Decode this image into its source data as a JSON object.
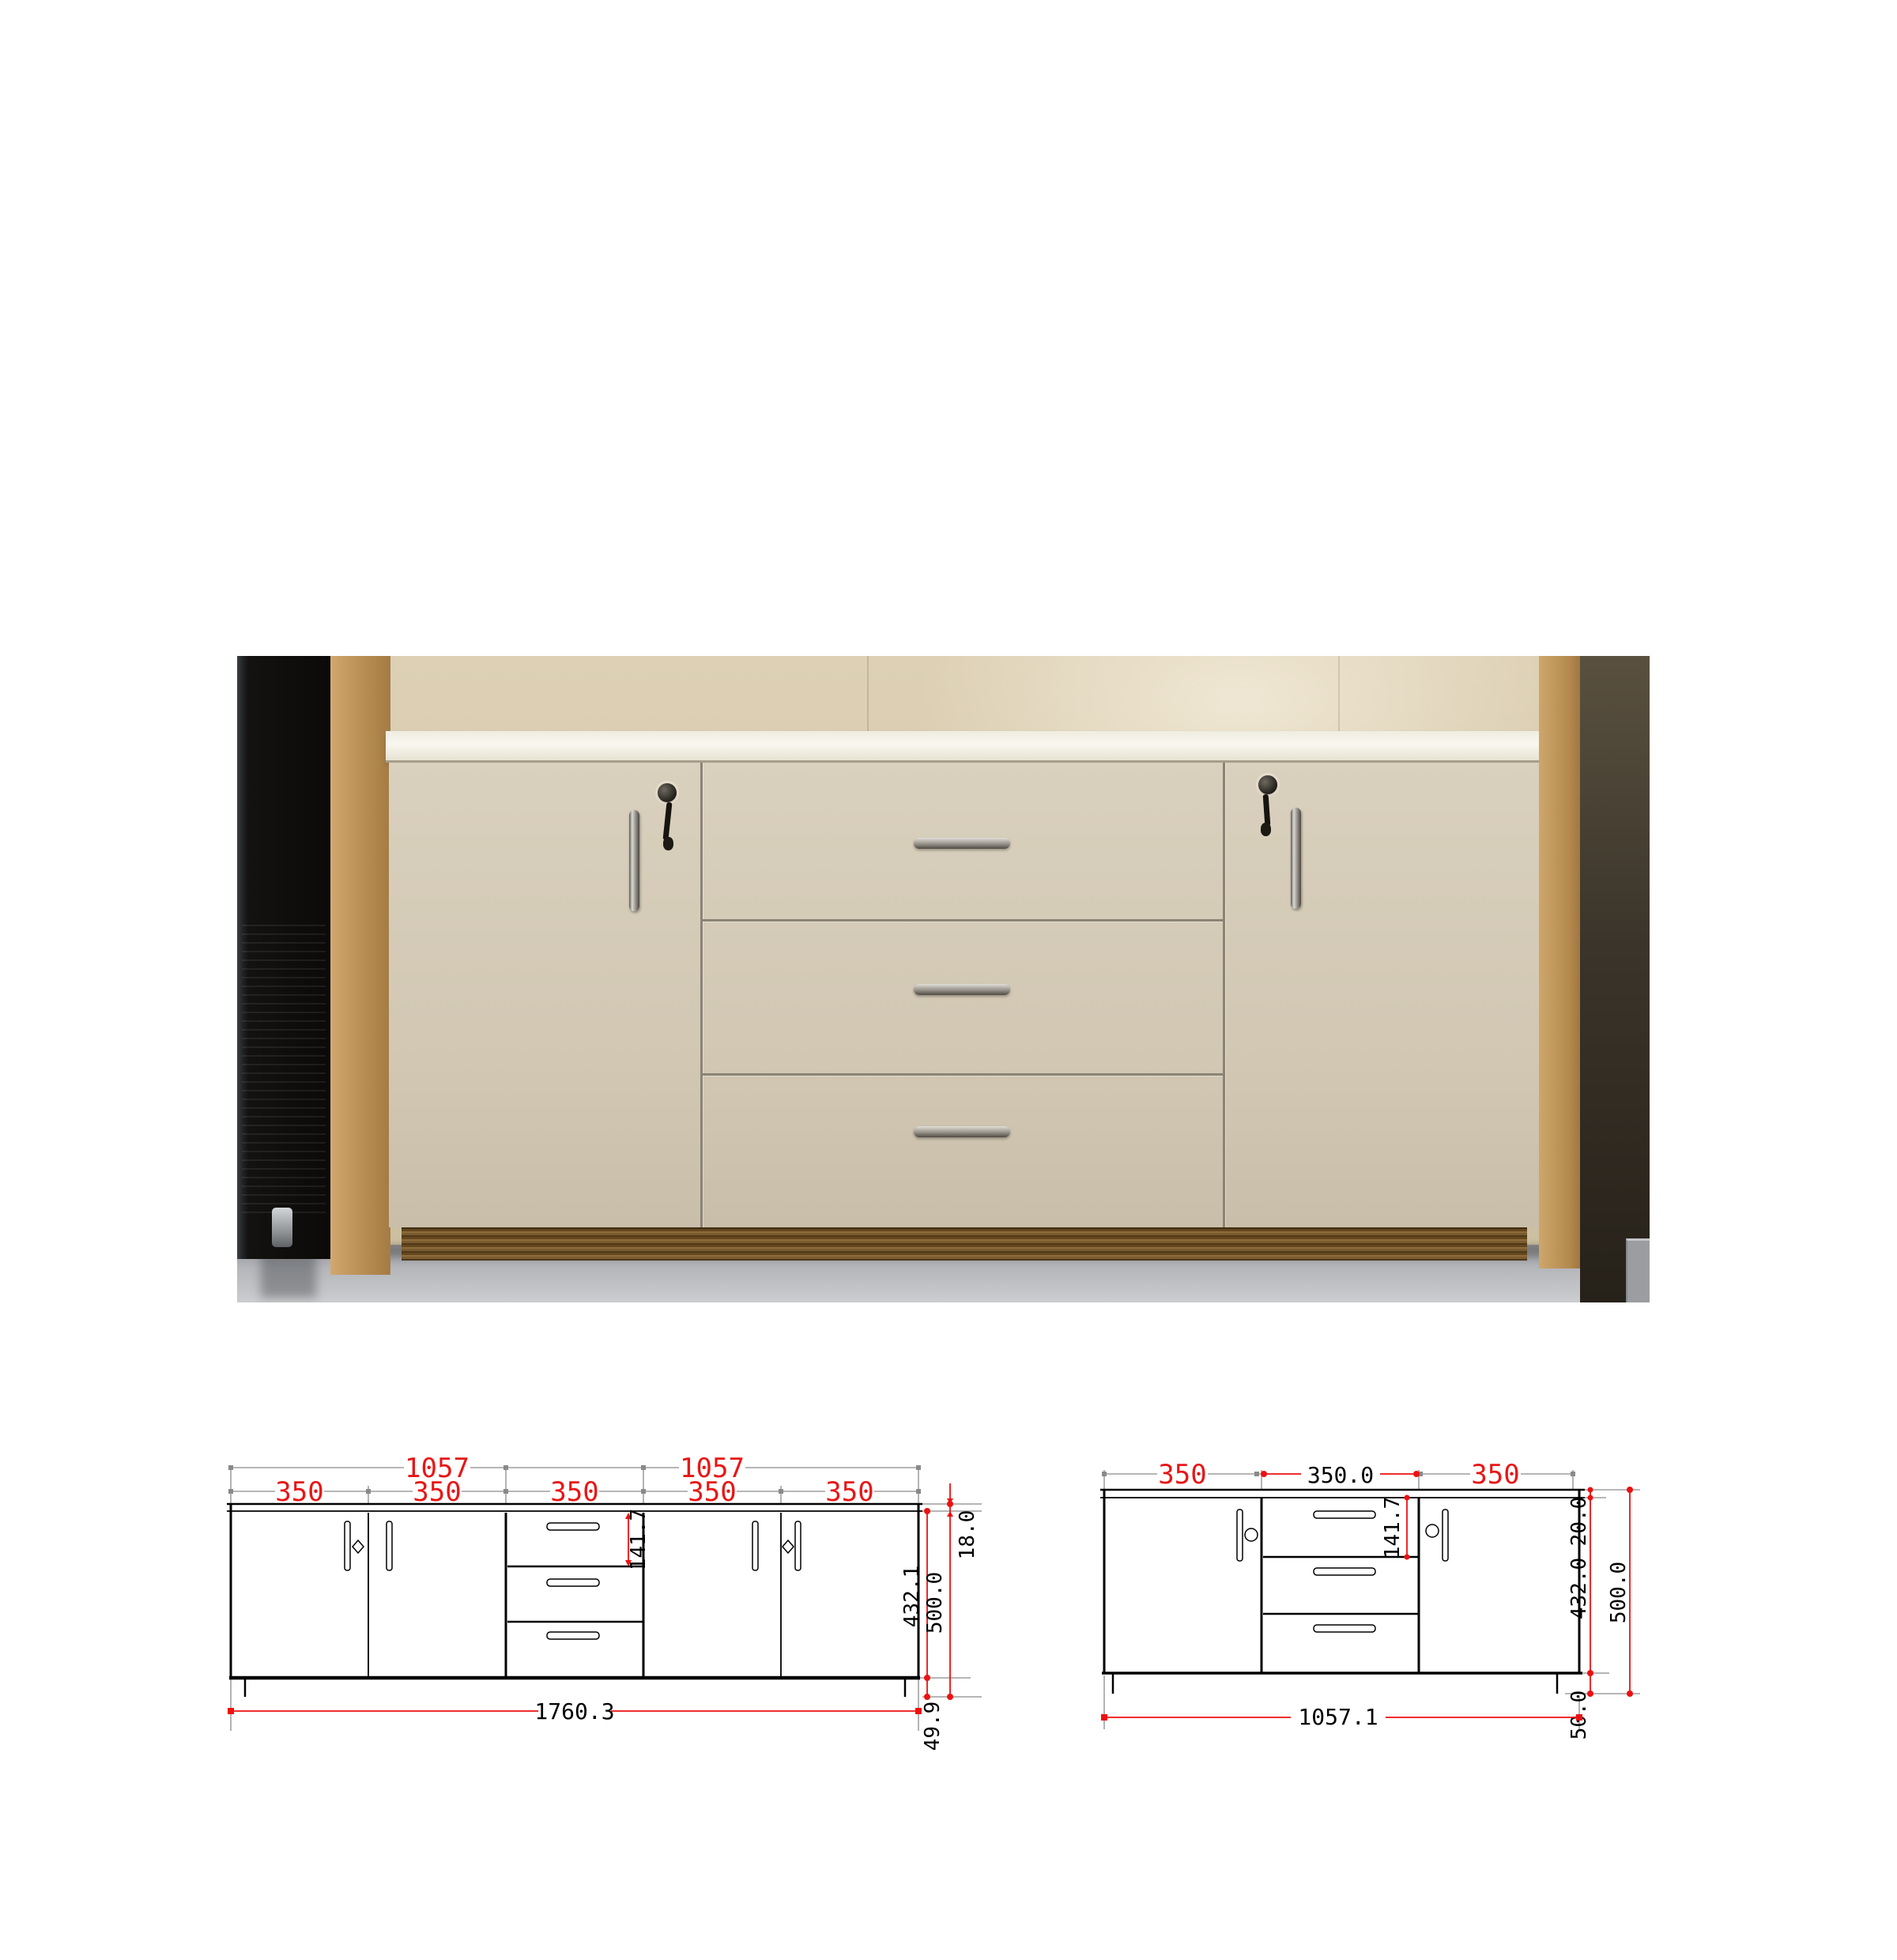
{
  "photo": {
    "description": "sideboard-cabinet-photo",
    "colors": {
      "wall": "#d6c9ad",
      "pillar": "#bd9258",
      "dark_wall": "#3b342a",
      "floor": "#b4b6ba",
      "black_unit": "#131210",
      "cabinet_body": "#d1c7b3",
      "countertop": "#f5f2e8",
      "plinth_wood": "#6f5128",
      "divider": "#8b8374",
      "handle_chrome": "#a6a29a",
      "step": "#9b9da0"
    }
  },
  "drawings": {
    "colors": {
      "dimension_red": "#e81616",
      "line_gray": "#8a8a8a",
      "line_black": "#000000"
    },
    "front": {
      "upper_widths": [
        "1057",
        "1057"
      ],
      "section_widths": [
        "350",
        "350",
        "350",
        "350",
        "350"
      ],
      "counter_thickness": "18.0",
      "carcass_height": "432.1",
      "overall_height": "500.0",
      "leg_height": "49.9",
      "drawer_height": "141.7",
      "overall_width": "1760.3"
    },
    "side": {
      "section_widths": [
        "350",
        "350.0",
        "350"
      ],
      "counter_thickness": "20.0",
      "carcass_height": "432.0",
      "overall_height": "500.0",
      "leg_height": "50.0",
      "drawer_height": "141.7",
      "overall_width": "1057.1"
    }
  }
}
